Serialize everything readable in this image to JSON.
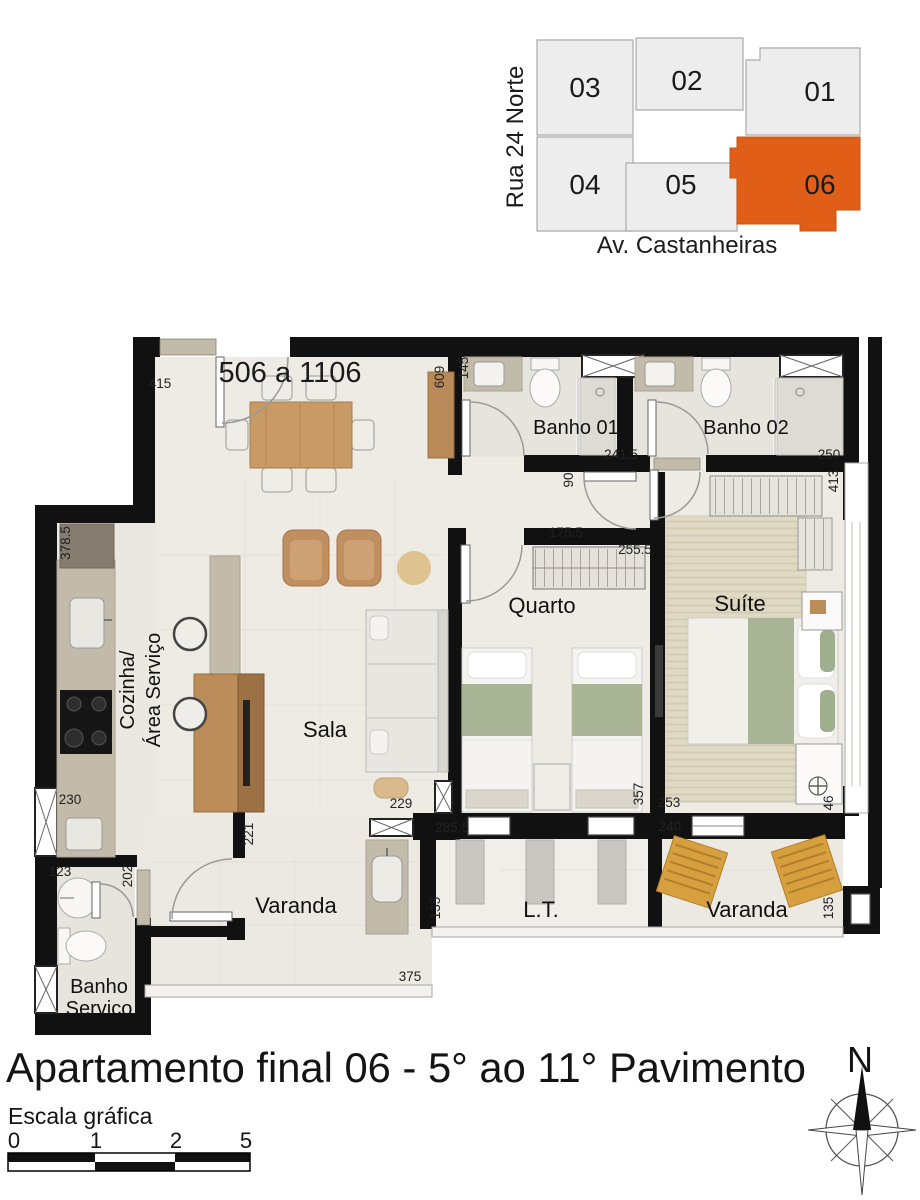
{
  "title": "Apartamento final 06 - 5° ao 11° Pavimento",
  "compass": {
    "label": "N"
  },
  "scale_bar": {
    "label": "Escala gráfica",
    "ticks": [
      "0",
      "1",
      "2",
      "5"
    ]
  },
  "colors": {
    "accent_orange": "#E05E17",
    "block_gray": "#EDEDEE",
    "wall_black": "#111111"
  },
  "key_plan": {
    "street_left": "Rua 24 Norte",
    "street_bottom": "Av. Castanheiras",
    "units": [
      {
        "label": "03",
        "highlighted": false
      },
      {
        "label": "02",
        "highlighted": false
      },
      {
        "label": "01",
        "highlighted": false
      },
      {
        "label": "04",
        "highlighted": false
      },
      {
        "label": "05",
        "highlighted": false
      },
      {
        "label": "06",
        "highlighted": true
      }
    ]
  },
  "floor_plan": {
    "unit_range": "506 a 1106",
    "rooms": {
      "banho1": "Banho 01",
      "banho2": "Banho 02",
      "quarto": "Quarto",
      "suite": "Suíte",
      "sala": "Sala",
      "cozinha_line1": "Cozinha/",
      "cozinha_line2": "Área Serviço",
      "varanda_left": "Varanda",
      "lt": "L.T.",
      "varanda_right": "Varanda",
      "servico_line1": "Banho",
      "servico_line2": "Serviço"
    },
    "dims": {
      "entry": "415",
      "sideboard": "609",
      "banho1_recess": "145",
      "banho1_width": "241.5",
      "banho2_width": "250",
      "hall_width": "90",
      "suite_side": "413",
      "quarto_wall": "175.5",
      "quarto_width": "255.5",
      "kitchen_side": "378.5",
      "kitchen_pass": "230",
      "sala_wall": "221",
      "sala_opening": "229",
      "quarto_depth": "357",
      "suite_bottom": "253",
      "suite_corner": "46",
      "lt_width": "285.5",
      "varanda_right_width": "240",
      "lt_side": "135",
      "varanda_right_side": "135",
      "servico_top": "123",
      "servico_side": "202",
      "varanda_left_width": "375"
    }
  }
}
